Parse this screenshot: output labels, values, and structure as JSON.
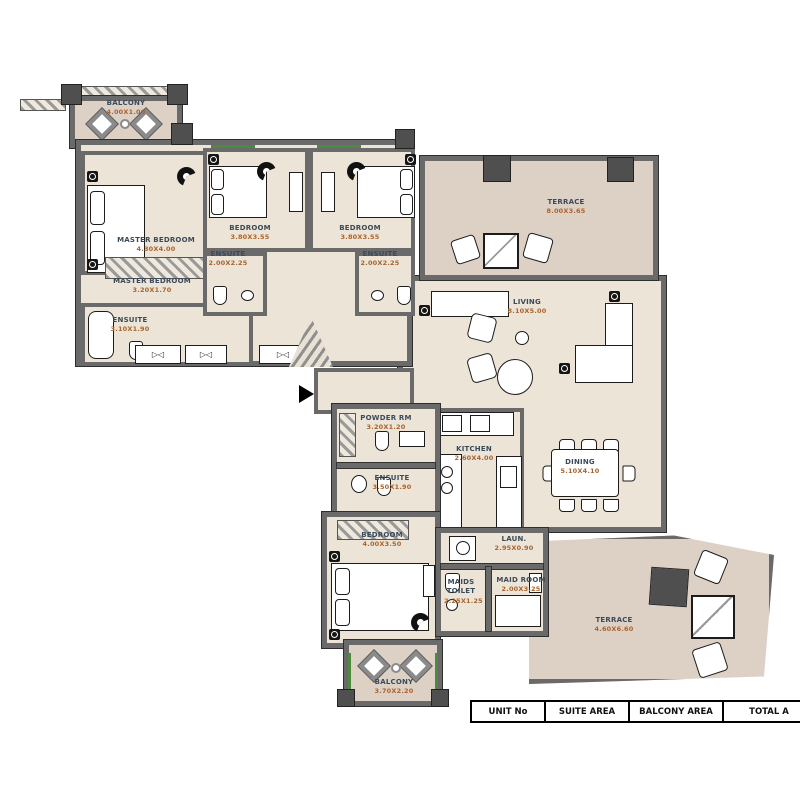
{
  "colors": {
    "wall": "#6a6a6a",
    "floor": "#ece4d6",
    "terrace": "#ddd1c6",
    "room_name": "#3b4a5a",
    "room_dims": "#a9632d",
    "accent_green": "#4c8b3f"
  },
  "rooms": {
    "balcony_top": {
      "name": "BALCONY",
      "dims": "4.00X1.00"
    },
    "master_bedroom": {
      "name": "MASTER BEDROOM",
      "dims": "4.30X4.00"
    },
    "master_dressing": {
      "name": "MASTER BEDROOM",
      "dims": "3.20X1.70"
    },
    "master_ensuite": {
      "name": "ENSUITE",
      "dims": "3.10X1.90"
    },
    "bedroom_2": {
      "name": "BEDROOM",
      "dims": "3.80X3.55"
    },
    "ensuite_2": {
      "name": "ENSUITE",
      "dims": "2.00X2.25"
    },
    "bedroom_3": {
      "name": "BEDROOM",
      "dims": "3.80X3.55"
    },
    "ensuite_3": {
      "name": "ENSUITE",
      "dims": "2.00X2.25"
    },
    "terrace_top": {
      "name": "TERRACE",
      "dims": "8.00X3.65"
    },
    "living": {
      "name": "LIVING",
      "dims": "8.10X5.00"
    },
    "kitchen": {
      "name": "KITCHEN",
      "dims": "2.60X4.00"
    },
    "dining": {
      "name": "DINING",
      "dims": "5.10X4.10"
    },
    "powder": {
      "name": "POWDER RM",
      "dims": "3.20X1.20"
    },
    "ensuite_4": {
      "name": "ENSUITE",
      "dims": "3.50X1.90"
    },
    "bedroom_4": {
      "name": "BEDROOM",
      "dims": "4.00X3.50"
    },
    "laundry": {
      "name": "LAUN.",
      "dims": "2.95X0.90"
    },
    "maids_toilet": {
      "name": "MAIDS TOILET",
      "dims": "2.25X1.25"
    },
    "maid_room": {
      "name": "MAID ROOM",
      "dims": "2.00X3.25"
    },
    "terrace_bottom": {
      "name": "TERRACE",
      "dims": "4.60X6.60"
    },
    "balcony_bottom": {
      "name": "BALCONY",
      "dims": "3.70X2.20"
    }
  },
  "wardrobe_glyph": "▷◁",
  "table": {
    "headers": [
      "UNIT No",
      "SUITE AREA",
      "BALCONY AREA",
      "TOTAL A"
    ]
  }
}
